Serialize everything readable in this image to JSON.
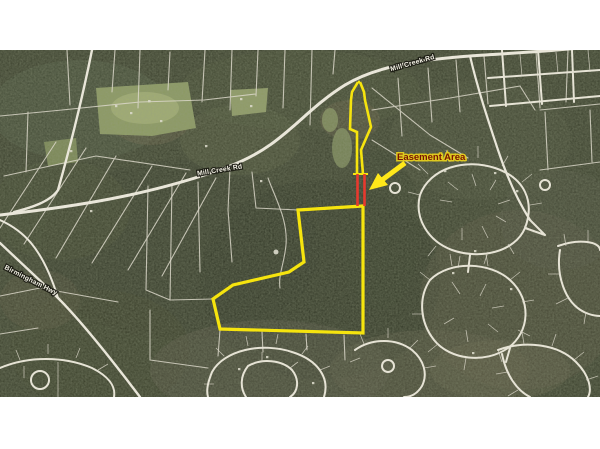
{
  "page": {
    "background_color": "#ffffff"
  },
  "map": {
    "type": "aerial-parcel-map",
    "easement_label": {
      "text": "Easement Area",
      "text_color": "#7a1400",
      "halo_color": "#e6d01e"
    },
    "road_labels": [
      {
        "id": "road-top-right",
        "text": "Mill Creek Rd"
      },
      {
        "id": "road-middle",
        "text": "Mill Creek Rd"
      },
      {
        "id": "road-left",
        "text": "Birmingham Hwy"
      }
    ],
    "overlay": {
      "boundary_color": "#f6e40e",
      "easement_color": "#e8392e",
      "arrow_color": "#ffe81a",
      "parcel_points": "298,160 363,156 363,283 220,279 213,249 233,235 289,222 304,212",
      "strip_left_d": "M358,32 L352,42 L351,50 L350,79 L357,82 L357,100 L357,124",
      "strip_right_d": "M360,32 L364,42 L365,50 L371,77 L361,100 L363,124",
      "strip_tip_d": "M358,32 L360,32",
      "crossbar_d": "M353,124 L368,124",
      "easement_left_d": "M357.5,124 L357.5,156",
      "easement_right_d": "M364.5,124 L364.5,156",
      "arrow_shaft_d": "M405,113 L382,130",
      "arrow_head_points": "369,140 378,123 388,135"
    }
  }
}
